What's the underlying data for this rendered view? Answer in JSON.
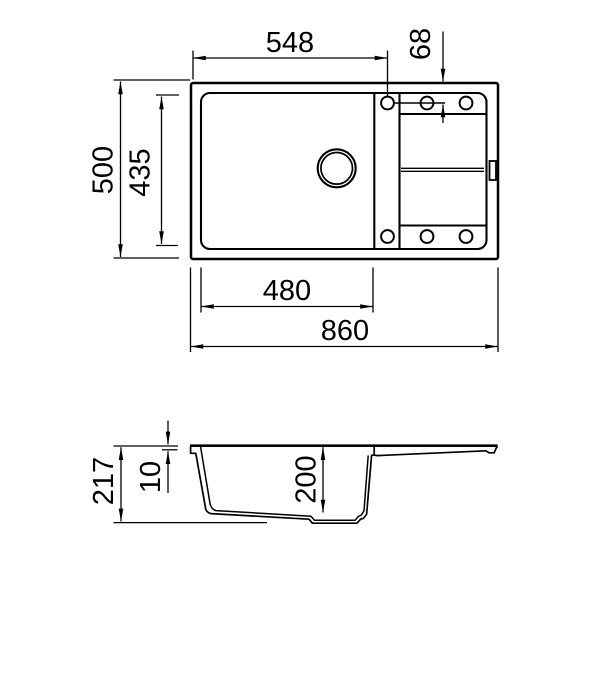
{
  "colors": {
    "line": "#000000",
    "background": "#ffffff"
  },
  "top_view": {
    "dim_left_edge_to_tap_holes": "548",
    "dim_tap_hole_offset_from_top": "68",
    "dim_overall_depth": "500",
    "dim_bowl_depth": "435",
    "dim_bowl_width": "480",
    "dim_overall_width": "860"
  },
  "side_view": {
    "dim_overall_height": "217",
    "dim_rim_thickness": "10",
    "dim_bowl_inner_depth": "200"
  }
}
